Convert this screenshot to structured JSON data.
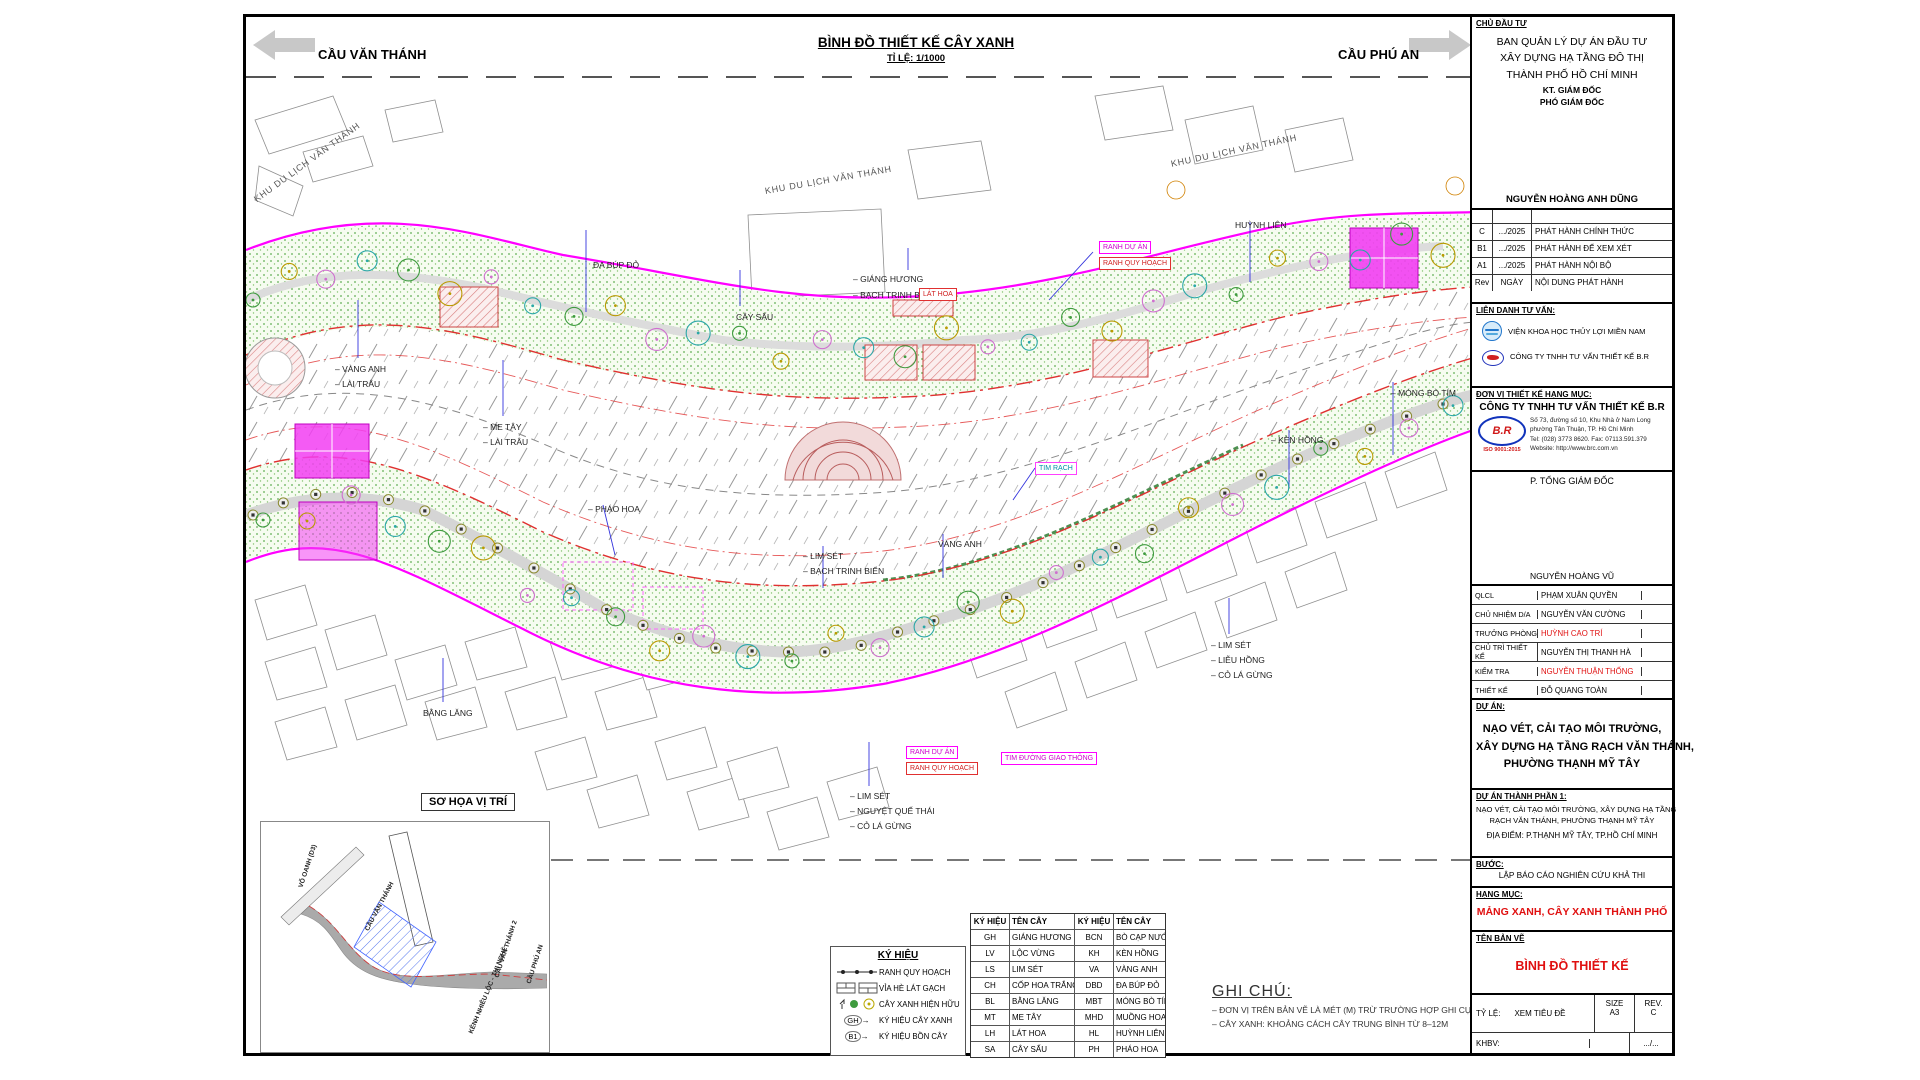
{
  "colors": {
    "boundary_magenta": "#ff00ff",
    "planning_red": "#e03030",
    "accent_red": "#e01010",
    "leader_blue": "#3333dd",
    "vegetation_green": "#5fae52"
  },
  "header": {
    "left_arrow_label": "CẦU VĂN THÁNH",
    "title": "BÌNH ĐỒ THIẾT KẾ CÂY XANH",
    "scale": "TỈ LỆ: 1/1000",
    "right_arrow_label": "CẦU PHÚ AN"
  },
  "map": {
    "area_labels": [
      {
        "t": "KHU DU LỊCH VĂN THÁNH",
        "x": 252,
        "y": 192,
        "r": -36
      },
      {
        "t": "KHU DU LỊCH VĂN THÁNH",
        "x": 762,
        "y": 183,
        "r": -10
      },
      {
        "t": "KHU DU LỊCH VĂN THÁNH",
        "x": 1168,
        "y": 156,
        "r": -12
      }
    ],
    "tree_labels": [
      {
        "t": "– VÀNG ANH",
        "x": 332,
        "y": 362
      },
      {
        "t": "– LÀI TRÂU",
        "x": 332,
        "y": 377
      },
      {
        "t": "– ME TÂY",
        "x": 480,
        "y": 420
      },
      {
        "t": "– LÀI TRÂU",
        "x": 480,
        "y": 435
      },
      {
        "t": "– PHÁO HOA",
        "x": 585,
        "y": 502
      },
      {
        "t": "ĐA BÚP ĐỎ",
        "x": 590,
        "y": 258
      },
      {
        "t": "– GIÁNG HƯƠNG",
        "x": 850,
        "y": 272
      },
      {
        "t": "– BẠCH TRINH BIỂN",
        "x": 850,
        "y": 288
      },
      {
        "t": "CÂY SẤU",
        "x": 733,
        "y": 310
      },
      {
        "t": "– LIM SÉT",
        "x": 800,
        "y": 549
      },
      {
        "t": "– BẠCH TRINH BIỂN",
        "x": 800,
        "y": 564
      },
      {
        "t": "VÀNG ANH",
        "x": 935,
        "y": 537
      },
      {
        "t": "– LIM SÉT",
        "x": 1208,
        "y": 638
      },
      {
        "t": "– LIỄU HỒNG",
        "x": 1208,
        "y": 653
      },
      {
        "t": "– CỎ LÁ GỪNG",
        "x": 1208,
        "y": 668
      },
      {
        "t": "BẰNG LĂNG",
        "x": 420,
        "y": 706
      },
      {
        "t": "– LIM SÉT",
        "x": 847,
        "y": 789
      },
      {
        "t": "– NGUYỆT QUẾ THÁI",
        "x": 847,
        "y": 804
      },
      {
        "t": "– CỎ LÁ GỪNG",
        "x": 847,
        "y": 819
      },
      {
        "t": "HUỲNH LIÊN",
        "x": 1232,
        "y": 218
      },
      {
        "t": "– MÓNG BÒ TÍM",
        "x": 1388,
        "y": 386
      },
      {
        "t": "– KÈN HỒNG",
        "x": 1268,
        "y": 433
      }
    ],
    "boxed_labels": [
      {
        "t": "RANH DỰ ÁN",
        "x": 1096,
        "y": 238,
        "k": "m"
      },
      {
        "t": "RANH QUY HOẠCH",
        "x": 1096,
        "y": 254,
        "k": "r"
      },
      {
        "t": "LÁT HOA",
        "x": 916,
        "y": 285,
        "k": "r"
      },
      {
        "t": "TIM RẠCH",
        "x": 1032,
        "y": 459,
        "k": "t"
      },
      {
        "t": "RANH DỰ ÁN",
        "x": 903,
        "y": 743,
        "k": "m"
      },
      {
        "t": "RANH QUY HOẠCH",
        "x": 903,
        "y": 759,
        "k": "r"
      },
      {
        "t": "TIM ĐƯỜNG GIAO THÔNG",
        "x": 998,
        "y": 749,
        "k": "m"
      }
    ],
    "inset": {
      "title": "SƠ HỌA VỊ TRÍ",
      "labels": [
        {
          "t": "VÕ OANH (D3)",
          "x": 40,
          "y": 62,
          "r": -72
        },
        {
          "t": "CẦU VĂN THÁNH",
          "x": 106,
          "y": 105,
          "r": -62
        },
        {
          "t": "CẦU VĂN THÁNH 2",
          "x": 236,
          "y": 152,
          "r": -72
        },
        {
          "t": "KÊNH NHIÊU LỘC - THỊ NGHÈ",
          "x": 210,
          "y": 208,
          "r": -68
        },
        {
          "t": "CẦU PHÚ AN",
          "x": 268,
          "y": 158,
          "r": -72
        }
      ]
    }
  },
  "legend_box": {
    "title": "KÝ HIỆU",
    "items": [
      {
        "label": "RANH QUY HOẠCH"
      },
      {
        "label": "VỈA HÈ LÁT GẠCH"
      },
      {
        "label": "CÂY XANH HIỆN HỮU"
      },
      {
        "label": "KÝ HIỆU CÂY XANH",
        "key": "GH"
      },
      {
        "label": "KÝ HIỆU BỒN CÂY",
        "key": "B1"
      }
    ]
  },
  "tree_table": {
    "headers": [
      "KÝ HIỆU",
      "TÊN CÂY",
      "KÝ HIỆU",
      "TÊN CÂY"
    ],
    "rows": [
      [
        "GH",
        "GIÁNG HƯƠNG",
        "BCN",
        "BÒ CẠP NƯỚC"
      ],
      [
        "LV",
        "LỘC VỪNG",
        "KH",
        "KÈN HỒNG"
      ],
      [
        "LS",
        "LIM SÉT",
        "VA",
        "VÀNG ANH"
      ],
      [
        "CH",
        "CỐP HOA TRẮNG",
        "DBD",
        "ĐA BÚP ĐỎ"
      ],
      [
        "BL",
        "BẰNG LĂNG",
        "MBT",
        "MÓNG BÒ TÍM"
      ],
      [
        "MT",
        "ME TÂY",
        "MHD",
        "MUỒNG HOA ĐÀO"
      ],
      [
        "LH",
        "LÁT HOA",
        "HL",
        "HUỲNH LIÊN"
      ],
      [
        "SA",
        "CÂY SẤU",
        "PH",
        "PHÁO HOA"
      ]
    ]
  },
  "notes": {
    "title": "GHI CHÚ:",
    "items": [
      "– ĐƠN VỊ TRÊN BẢN VẼ LÀ MÉT (M) TRỪ TRƯỜNG HỢP GHI CỤ THỂ",
      "– CÂY XANH: KHOẢNG CÁCH CÂY TRUNG BÌNH TỪ 8–12M"
    ]
  },
  "title_block": {
    "owner_heading": "CHỦ ĐẦU TƯ",
    "owner_lines": [
      "BAN QUẢN LÝ DỰ ÁN ĐẦU TƯ",
      "XÂY DỰNG HẠ TẦNG ĐÔ THỊ",
      "THÀNH PHỐ HỒ CHÍ MINH"
    ],
    "owner_role1": "KT. GIÁM ĐỐC",
    "owner_role2": "PHÓ GIÁM ĐỐC",
    "owner_signer": "NGUYỄN HOÀNG ANH DŨNG",
    "revisions": [
      {
        "rev": "C",
        "date": ".../2025",
        "desc": "PHÁT HÀNH CHÍNH THỨC"
      },
      {
        "rev": "B1",
        "date": ".../2025",
        "desc": "PHÁT HÀNH ĐỂ XEM XÉT"
      },
      {
        "rev": "A1",
        "date": ".../2025",
        "desc": "PHÁT HÀNH NỘI BỘ"
      },
      {
        "rev": "Rev",
        "date": "NGÀY",
        "desc": "NỘI DUNG PHÁT HÀNH"
      }
    ],
    "consortium_heading": "LIÊN DANH TƯ VẤN:",
    "consortium": [
      "VIỆN KHOA HỌC THỦY LỢI MIỀN NAM",
      "CÔNG TY TNHH TƯ VẤN THIẾT KẾ B.R"
    ],
    "design_unit_heading": "ĐƠN VỊ THIẾT KẾ HẠNG MỤC:",
    "design_unit": "CÔNG TY TNHH TƯ VẤN THIẾT KẾ B.R",
    "company_logo": "B.R",
    "company_iso": "ISO 9001:2015",
    "company_address": [
      "Số 73, đường số 10, Khu Nhà ở Nam Long",
      "phường Tân Thuận, TP. Hồ Chí Minh",
      "Tel: (028) 3773 8620. Fax: 07113.591.379",
      "Website: http://www.brc.com.vn"
    ],
    "director_role": "P. TỔNG GIÁM ĐỐC",
    "director_name": "NGUYỄN HOÀNG VŨ",
    "staff": [
      {
        "role": "QLCL",
        "name": "PHẠM XUÂN QUYỀN",
        "red": false
      },
      {
        "role": "CHỦ NHIỆM D/A",
        "name": "NGUYỄN VĂN CƯỜNG",
        "red": false
      },
      {
        "role": "TRƯỞNG PHÒNG",
        "name": "HUỲNH CAO TRÍ",
        "red": true
      },
      {
        "role": "CHỦ TRÌ THIẾT KẾ",
        "name": "NGUYỄN THỊ THANH HÀ",
        "red": false
      },
      {
        "role": "KIỂM TRA",
        "name": "NGUYỄN THUẬN THỐNG",
        "red": true
      },
      {
        "role": "THIẾT KẾ",
        "name": "ĐỖ QUANG TOÀN",
        "red": false
      }
    ],
    "project_heading": "DỰ ÁN:",
    "project_name": [
      "NẠO VÉT, CẢI TẠO MÔI TRƯỜNG,",
      "XÂY DỰNG HẠ TẦNG RẠCH VĂN THÁNH,",
      "PHƯỜNG THẠNH MỸ TÂY"
    ],
    "component_heading": "DỰ ÁN THÀNH PHẦN 1:",
    "component_lines": [
      "NẠO VÉT, CẢI TẠO MÔI TRƯỜNG, XÂY DỰNG HẠ TẦNG",
      "RẠCH VĂN THÁNH, PHƯỜNG THẠNH MỸ TÂY"
    ],
    "component_location": "ĐỊA ĐIỂM: P.THẠNH MỸ TÂY, TP.HỒ CHÍ MINH",
    "phase_heading": "BƯỚC:",
    "phase_value": "LẬP BÁO CÁO NGHIÊN CỨU KHẢ THI",
    "category_heading": "HẠNG MỤC:",
    "category_value": "MẢNG XANH, CÂY XANH THÀNH PHỐ",
    "drawing_heading": "TÊN BẢN VẼ",
    "drawing_value": "BÌNH ĐỒ THIẾT KẾ",
    "scale_label": "TỶ LỆ:",
    "scale_value": "XEM TIÊU ĐỀ",
    "size_label": "SIZE",
    "size_value": "A3",
    "rev_label": "REV.",
    "rev_value": "C",
    "khbv_label": "KHBV:",
    "sheet_no": ".../..."
  }
}
